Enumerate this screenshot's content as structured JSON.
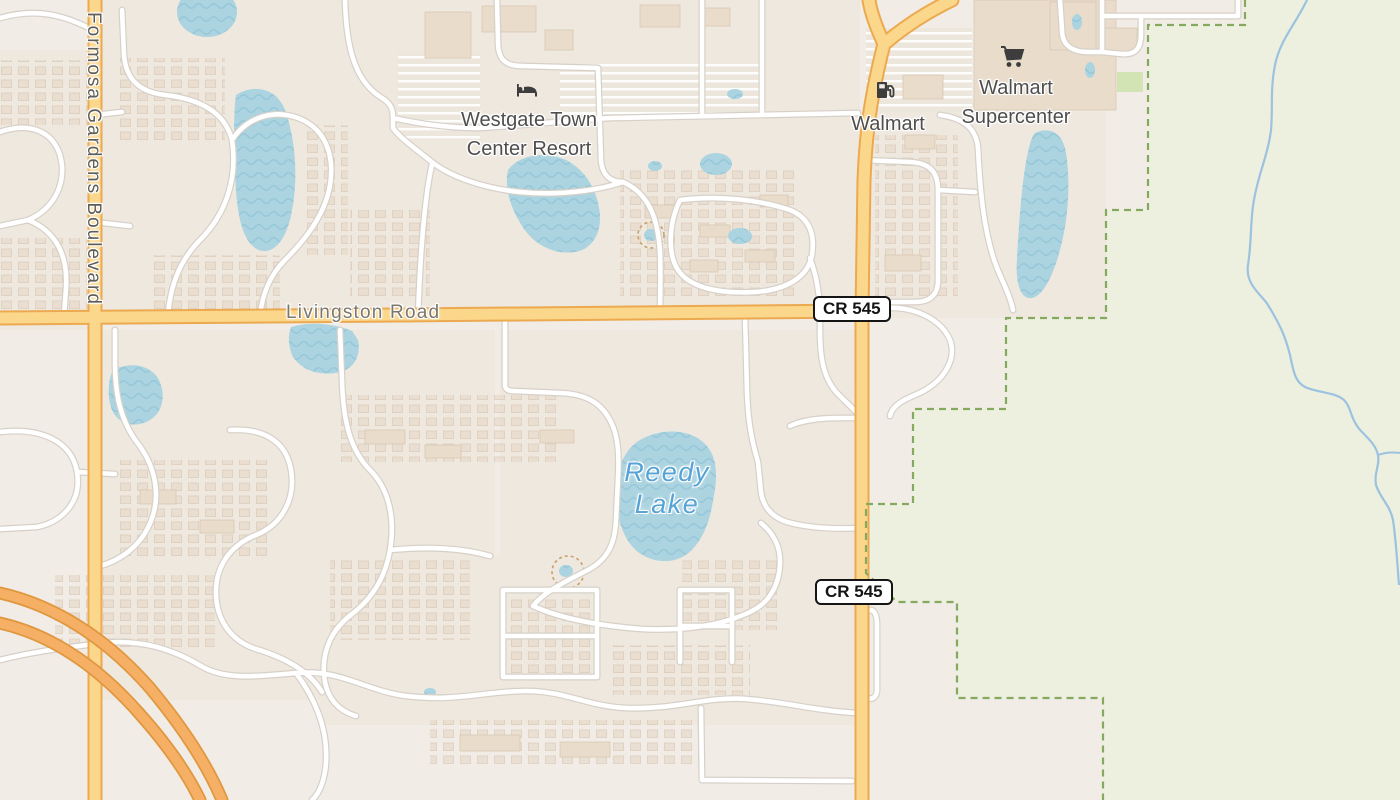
{
  "map": {
    "labels": {
      "formosa_blvd": "Formosa Gardens Boulevard",
      "livingston_road": "Livingston Road",
      "route_shield": "CR 545",
      "westgate_resort": "Westgate Town Center Resort",
      "walmart": "Walmart",
      "walmart_supercenter": "Walmart Supercenter",
      "reedy_lake": "Reedy Lake"
    },
    "icons": {
      "lodging": "bed-lodging-icon",
      "fuel": "fuel-pump-icon",
      "cart": "shopping-cart-icon"
    },
    "colors": {
      "background": "#f1ede6",
      "residential_tint": "#ece4d8",
      "water": "#abd4e0",
      "water_wave": "#93c4d8",
      "stream": "#9cc2e0",
      "nature_reserve": "#edf0df",
      "reserve_boundary": "#85a95e",
      "park_green": "#d2e3b4",
      "road_minor_fill": "#ffffff",
      "road_minor_casing": "#d6d0c8",
      "road_secondary_fill": "#fbd78b",
      "road_secondary_casing": "#eca950",
      "motorway_fill": "#f5b066",
      "motorway_casing": "#e0973f",
      "building_fill": "#e9dccb",
      "building_stroke": "#d9c7b2",
      "poi_label": "#4e4e4e",
      "road_label": "#7c766b",
      "water_label": "#57a3d6",
      "scrub_outline": "#c9a06a"
    }
  }
}
